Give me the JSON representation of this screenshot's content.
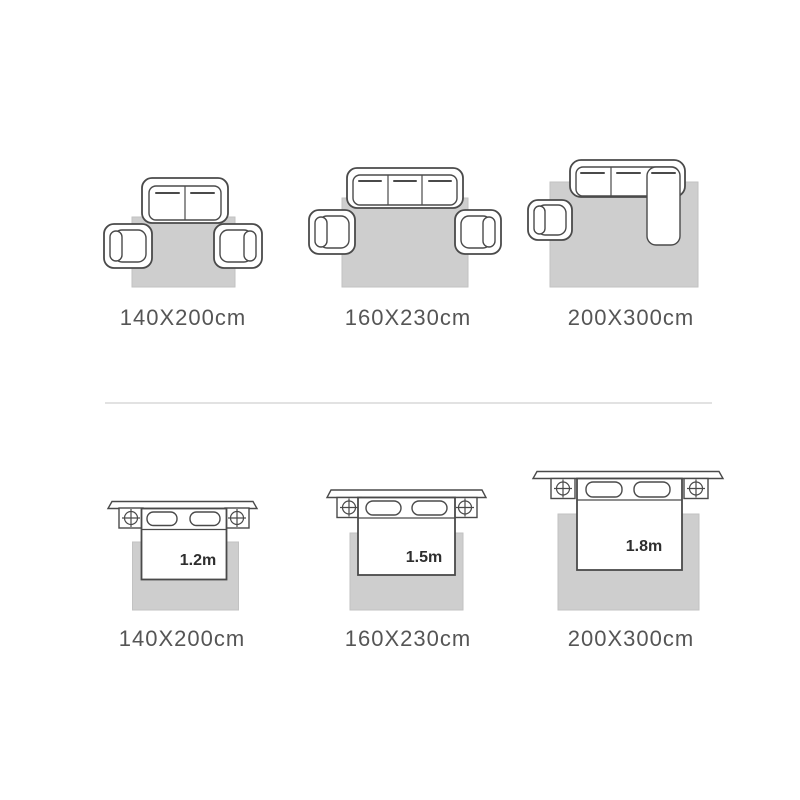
{
  "colors": {
    "background": "#ffffff",
    "rug": "#cecece",
    "rug_border": "#c2c2c2",
    "line": "#4a4a4a",
    "label": "#555555",
    "bed_size_text": "#2e2e2e",
    "divider": "#e2e2e2"
  },
  "sofa_section": {
    "items": [
      {
        "label": "140X200cm"
      },
      {
        "label": "160X230cm"
      },
      {
        "label": "200X300cm"
      }
    ]
  },
  "bed_section": {
    "items": [
      {
        "label": "140X200cm",
        "bed_width": "1.2m"
      },
      {
        "label": "160X230cm",
        "bed_width": "1.5m"
      },
      {
        "label": "200X300cm",
        "bed_width": "1.8m"
      }
    ]
  }
}
